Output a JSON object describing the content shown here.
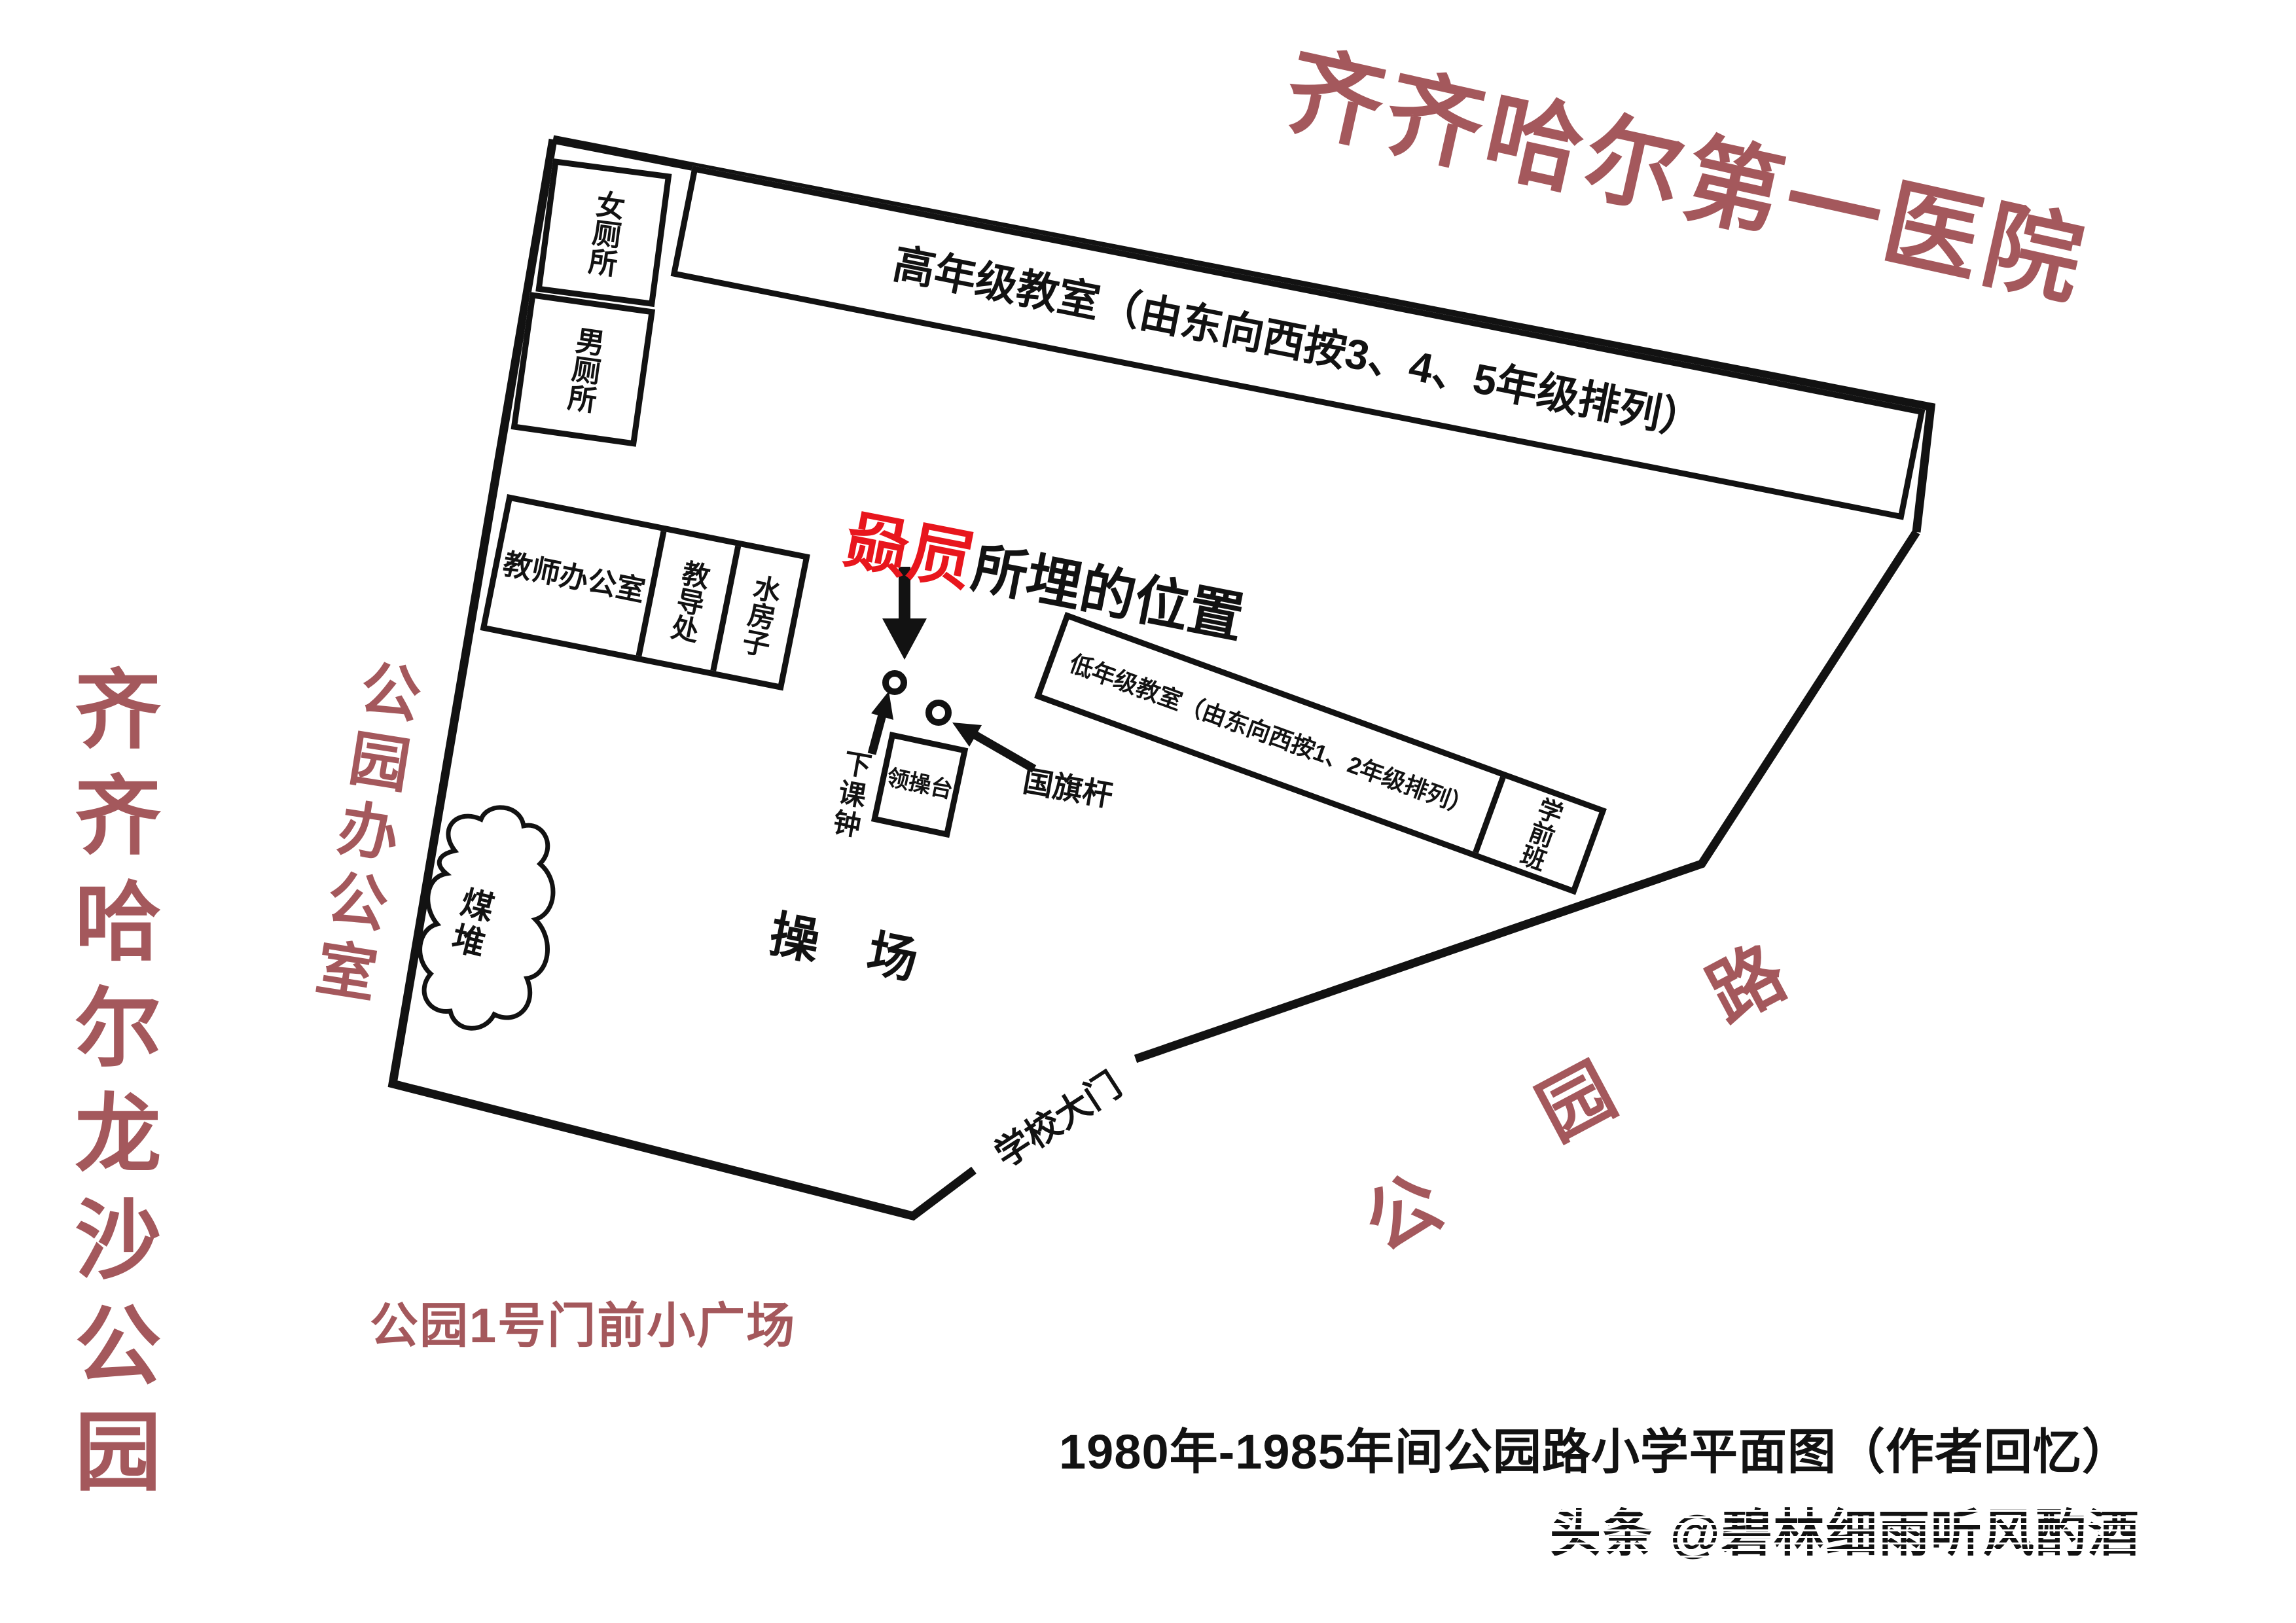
{
  "map": {
    "caption": "1980年-1985年间公园路小学平面图（作者回忆）",
    "watermark": "头条 @碧林细雨听风酌酒",
    "colors": {
      "landmark_red": "#A4585C",
      "highlight_red": "#E8161D",
      "ink": "#121212"
    }
  },
  "surroundings": {
    "hospital": "齐齐哈尔第一医院",
    "park": "齐齐哈尔龙沙公园",
    "park_office": "公园办公室",
    "road_chars": [
      "公",
      "园",
      "路"
    ],
    "plaza": "公园1号门前小广场"
  },
  "buildings": {
    "women_toilet": "女厕所",
    "men_toilet": "男厕所",
    "upper_classrooms": "高年级教室（由东向西按3、4、5年级排列）",
    "teachers_office": "教师办公室",
    "deans_office": "教导处",
    "water_house": "水房子",
    "lower_classrooms": "低年级教室（由东向西按1、2年级排列）",
    "preschool": "学前班",
    "platform": "领操台"
  },
  "features": {
    "bixi_highlight": "赑屃",
    "bixi_rest": "所埋的位置",
    "bell": "下课钟",
    "flagpole": "国旗杆",
    "coal_pile": "煤堆",
    "playground": "操　场",
    "gate": "学校大门"
  }
}
